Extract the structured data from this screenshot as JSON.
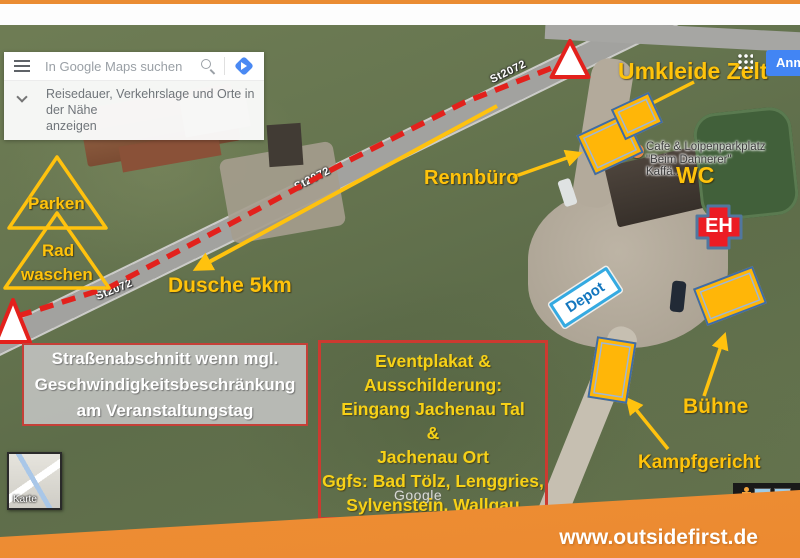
{
  "header": {
    "search_placeholder": "In Google Maps suchen",
    "suggestion_line1": "Reisedauer, Verkehrslage und Orte in der Nähe",
    "suggestion_line2": "anzeigen",
    "signin_label": "Anmelden"
  },
  "map": {
    "road_label": "St2072",
    "poi": {
      "line1": "Cafe & Loipenparkplatz",
      "line2": "\"Beim Dannerer\" Kaffä..."
    },
    "watermark": "Google",
    "minimap_label": "Karte"
  },
  "annotations": {
    "umkleide_zelt": "Umkleide Zelt",
    "wc": "WC",
    "rennbuero": "Rennbüro",
    "parken": "Parken",
    "rad": "Rad",
    "waschen": "waschen",
    "dusche": "Dusche 5km",
    "depot": "Depot",
    "eh": "EH",
    "buehne": "Bühne",
    "kampfgericht": "Kampfgericht",
    "box_road": {
      "lines": [
        "Straßenabschnitt wenn mgl.",
        "Geschwindigkeitsbeschränkung",
        "am Veranstaltungstag"
      ]
    },
    "box_event": {
      "lines": [
        "Eventplakat &",
        "Ausschilderung:",
        "Eingang Jachenau Tal",
        "&",
        "Jachenau Ort",
        "Ggfs: Bad Tölz, Lenggries,",
        "Sylvenstein, Wallgau"
      ]
    }
  },
  "footer": {
    "url": "www.outsidefirst.de"
  },
  "colors": {
    "accent_orange": "#EE8F3B",
    "annotation_yellow": "#FFC20E",
    "alert_red": "#E3211C",
    "depot_blue": "#1878BE",
    "google_blue": "#4285F4"
  }
}
